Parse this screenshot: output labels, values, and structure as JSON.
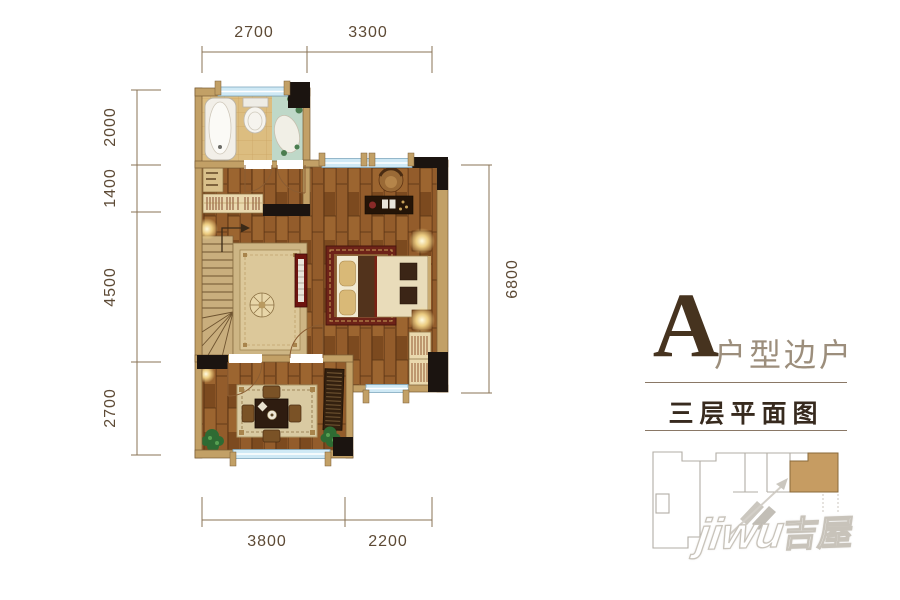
{
  "dimensions": {
    "top": [
      "2700",
      "3300"
    ],
    "left": [
      "2000",
      "1400",
      "4500",
      "2700"
    ],
    "right": [
      "6800"
    ],
    "bottom": [
      "3800",
      "2200"
    ]
  },
  "panel": {
    "unit_letter": "A",
    "unit_type_label": "户型边户",
    "floor_label": "三层平面图"
  },
  "watermark": {
    "latin": "jiwu",
    "cjk": "吉屋"
  },
  "colors": {
    "unit_highlight": "#c69c62",
    "wall_tan": "#c2a066",
    "window_blue": "#cfe9f5",
    "dim_text": "#5d4a35"
  }
}
